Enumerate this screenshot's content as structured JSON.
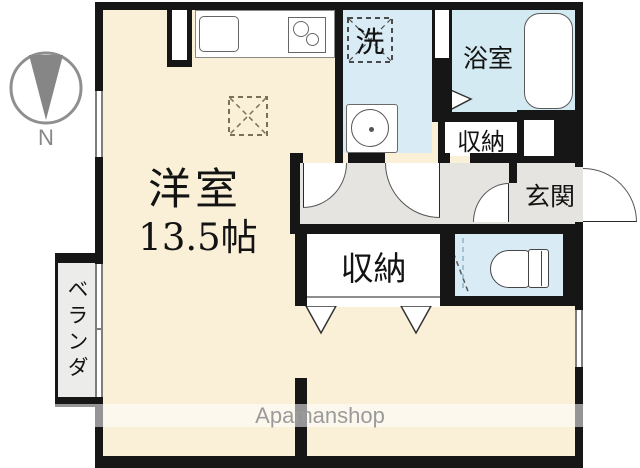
{
  "compass": {
    "north_label": "N"
  },
  "rooms": {
    "main_room": {
      "name": "洋室",
      "area": "13.5帖"
    },
    "washroom": {
      "washer_symbol": "洗"
    },
    "bathroom": {
      "name": "浴室"
    },
    "upper_closet": {
      "name": "収納"
    },
    "entrance": {
      "name": "玄関"
    },
    "lower_closet": {
      "name": "収納"
    },
    "veranda": {
      "name": "ベランダ"
    }
  },
  "watermark": {
    "brand": "Apamanshop"
  },
  "colors": {
    "room_floor": "#FAF0D8",
    "wet_area_floor": "#D9EBF4",
    "hallway_floor": "#E5E4E1",
    "veranda_floor": "#ECECEA",
    "wall": "#161616",
    "watermark_text": "#9B9B9B",
    "compass_gray": "#878787"
  }
}
